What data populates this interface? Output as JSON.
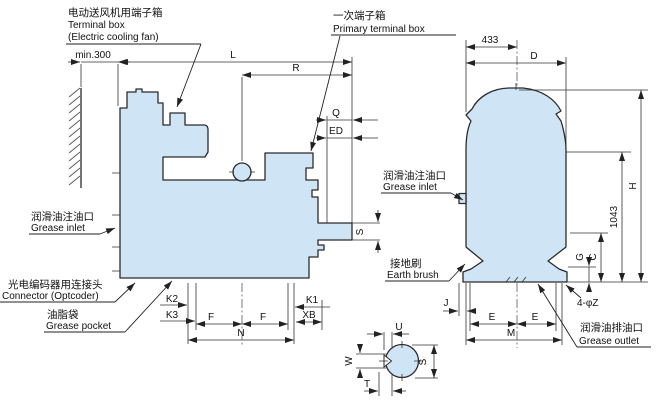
{
  "labels": {
    "fan_box": {
      "cn": "电动送风机用端子箱",
      "en1": "Terminal box",
      "en2": "(Electric cooling fan)"
    },
    "primary_box": {
      "cn": "一次端子箱",
      "en": "Primary terminal box"
    },
    "grease_inlet_left": {
      "cn": "润滑油注油口",
      "en": "Grease inlet"
    },
    "connector": {
      "cn": "光电编码器用连接头",
      "en": "Connector (Optcoder)"
    },
    "grease_pocket": {
      "cn": "油脂袋",
      "en": "Grease pocket"
    },
    "grease_inlet_right": {
      "cn": "润滑油注油口",
      "en": "Grease inlet"
    },
    "earth_brush": {
      "cn": "接地刷",
      "en": "Earth brush"
    },
    "grease_outlet": {
      "cn": "润滑油排油口",
      "en": "Grease outlet"
    }
  },
  "dims": {
    "min300": "min.300",
    "L": "L",
    "R": "R",
    "Q": "Q",
    "ED": "ED",
    "S_shaft": "S",
    "K1": "K1",
    "K2": "K2",
    "K3": "K3",
    "XB": "XB",
    "F1": "F",
    "F2": "F",
    "N": "N",
    "w433": "433",
    "D": "D",
    "H": "H",
    "h1043": "1043",
    "G": "G",
    "C": "C",
    "J": "J",
    "E1": "E",
    "E2": "E",
    "M": "M",
    "phiZ": "4-φZ",
    "U": "U",
    "W": "W",
    "T": "T",
    "S_end": "S"
  },
  "colors": {
    "body_fill": "#cfe5f6",
    "line": "#2b2b2b"
  }
}
